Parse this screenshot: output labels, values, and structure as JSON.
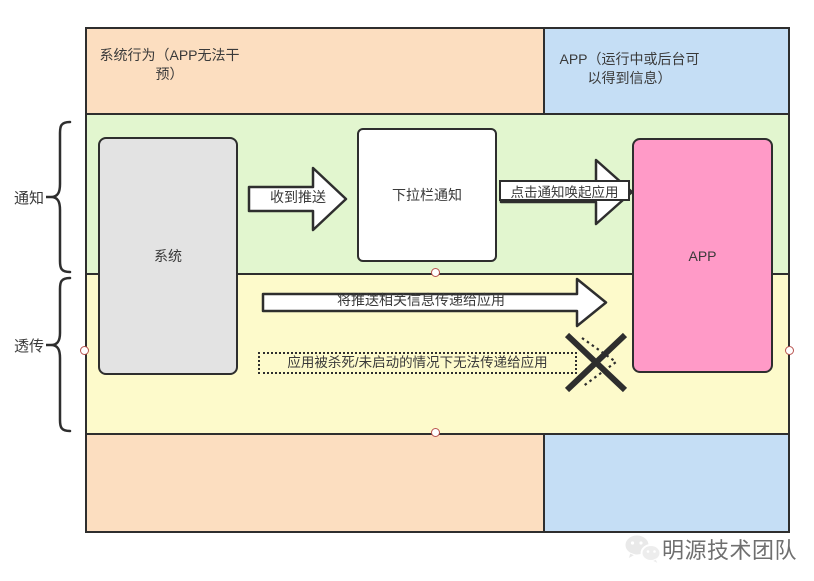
{
  "diagram": {
    "header": {
      "left_label": "系统行为（APP无法干预）",
      "right_label": "APP（运行中或后台可以得到信息）"
    },
    "lanes": {
      "notification_label": "通知",
      "passthrough_label": "透传"
    },
    "nodes": {
      "system_label": "系统",
      "dropdown_label": "下拉栏通知",
      "app_label": "APP"
    },
    "arrows": {
      "receive_push": "收到推送",
      "click_notification": "点击通知唤起应用",
      "pass_info": "将推送相关信息传递给应用",
      "blocked_note": "应用被杀死/未启动的情况下无法传递给应用"
    },
    "colors": {
      "peach": "#fcdec0",
      "blue": "#c5def5",
      "green": "#e2f6cf",
      "yellow": "#fdfacb",
      "pink": "#ff9ac7",
      "gray": "#e3e3e3",
      "border": "#2e2e2e",
      "connection_point": "#b85450"
    }
  },
  "watermark": {
    "label": "明源技术团队"
  }
}
